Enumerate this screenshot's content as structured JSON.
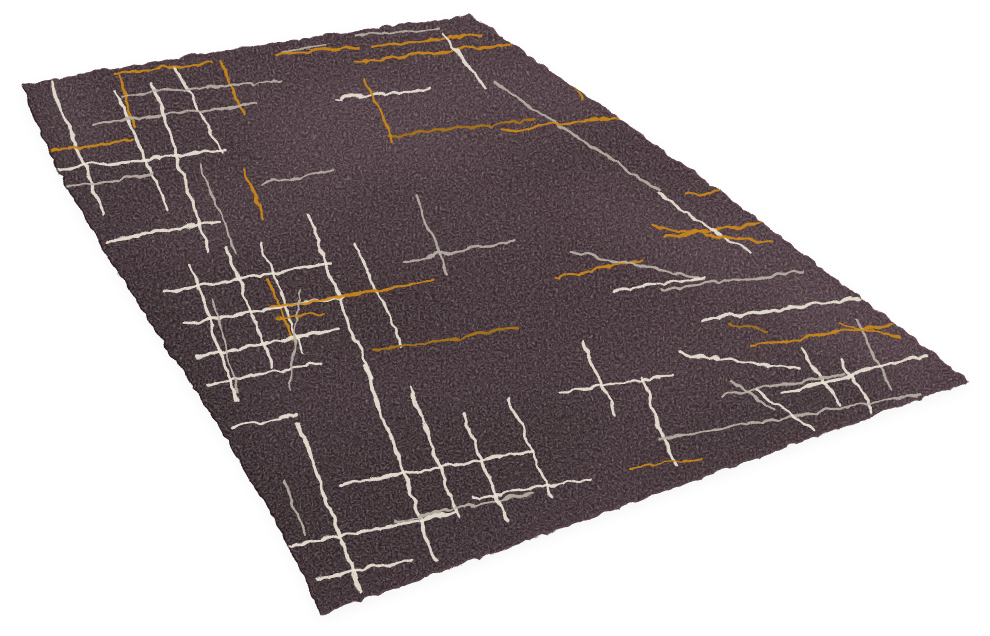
{
  "scene": {
    "type": "product-photo",
    "subject": "Hand-tufted rectangular area rug in dark espresso plum with abstract scratched criss-cross line pattern in ivory, silver-grey and goldenrod, photographed at an angle on a plain white background",
    "background_color": "#ffffff",
    "rug": {
      "outline": {
        "left_corner": [
          21,
          83
        ],
        "top_corner": [
          468,
          14
        ],
        "right_corner": [
          968,
          380
        ],
        "bottom_corner": [
          318,
          614
        ],
        "ctrl_top_edge": [
          244,
          42
        ],
        "ctrl_right_edge": [
          692,
          163
        ],
        "ctrl_bottom_edge": [
          643,
          497
        ],
        "ctrl_left_edge_1": [
          60,
          225
        ],
        "ctrl_left_edge_2": [
          255,
          445
        ]
      },
      "ground_gradient": [
        "#2c2024",
        "#392a2f",
        "#443238",
        "#4e3b42"
      ],
      "line_colors": {
        "iv": "#e9e3d5",
        "si": "#b7afa4",
        "go": "#c9861d",
        "am": "#a87418"
      },
      "rim_colors": {
        "top": "#5e474d",
        "right": "#6d5056",
        "bottom": "#6b5153",
        "left": "#1f1418"
      },
      "shadow_color": "#8a8284",
      "seed": 7,
      "patches": [
        [
          430,
          120,
          180,
          48,
          -8,
          "#6a525c",
          0.28
        ],
        [
          700,
          235,
          150,
          42,
          21,
          "#655058",
          0.24
        ],
        [
          250,
          205,
          120,
          36,
          -14,
          "#5d4950",
          0.2
        ],
        [
          855,
          330,
          95,
          30,
          26,
          "#6e575f",
          0.26
        ],
        [
          75,
          115,
          55,
          24,
          62,
          "#6b565e",
          0.28
        ],
        [
          300,
          95,
          90,
          26,
          -10,
          "#5f4a52",
          0.22
        ],
        [
          180,
          420,
          160,
          62,
          62,
          "#1f1518",
          0.3
        ],
        [
          420,
          480,
          200,
          62,
          -19,
          "#241a1e",
          0.28
        ],
        [
          600,
          155,
          150,
          42,
          14,
          "#2a1e23",
          0.22
        ],
        [
          330,
          305,
          110,
          44,
          8,
          "#271b1f",
          0.2
        ],
        [
          760,
          420,
          130,
          36,
          -18,
          "#231a1e",
          0.24
        ],
        [
          520,
          300,
          160,
          54,
          -5,
          "#2c1f24",
          0.18
        ]
      ],
      "lines": [
        [
          50,
          82,
          102,
          214,
          "iv",
          3
        ],
        [
          114,
          90,
          166,
          208,
          "iv",
          3
        ],
        [
          172,
          64,
          220,
          150,
          "iv",
          2.5
        ],
        [
          117,
          72,
          133,
          122,
          "go",
          2.5
        ],
        [
          218,
          58,
          242,
          112,
          "go",
          2.5
        ],
        [
          52,
          168,
          224,
          148,
          "iv",
          3
        ],
        [
          58,
          187,
          152,
          172,
          "si",
          2.5
        ],
        [
          105,
          240,
          218,
          220,
          "iv",
          3
        ],
        [
          48,
          150,
          130,
          138,
          "go",
          2.5
        ],
        [
          92,
          122,
          254,
          102,
          "si",
          2.5
        ],
        [
          150,
          80,
          208,
          250,
          "iv",
          3
        ],
        [
          112,
          72,
          210,
          61,
          "go",
          2.5
        ],
        [
          198,
          162,
          235,
          252,
          "si",
          2
        ],
        [
          120,
          95,
          280,
          79,
          "si",
          2
        ],
        [
          279,
          50,
          326,
          44,
          "si",
          2
        ],
        [
          354,
          60,
          562,
          38,
          "go",
          2.5
        ],
        [
          370,
          45,
          480,
          33,
          "go",
          2.5
        ],
        [
          274,
          53,
          360,
          45,
          "go",
          2.5
        ],
        [
          354,
          34,
          436,
          27,
          "si",
          2
        ],
        [
          442,
          32,
          484,
          88,
          "iv",
          2.5
        ],
        [
          492,
          80,
          660,
          190,
          "si",
          2.5
        ],
        [
          502,
          130,
          658,
          111,
          "go",
          2.5
        ],
        [
          388,
          135,
          532,
          119,
          "am",
          2.5
        ],
        [
          337,
          98,
          427,
          87,
          "iv",
          2.5
        ],
        [
          364,
          77,
          392,
          142,
          "go",
          2.5
        ],
        [
          548,
          42,
          580,
          97,
          "go",
          2.5
        ],
        [
          684,
          194,
          908,
          163,
          "go",
          2.5
        ],
        [
          662,
          235,
          838,
          212,
          "go",
          2.5
        ],
        [
          662,
          288,
          802,
          270,
          "si",
          2.5
        ],
        [
          702,
          318,
          892,
          292,
          "iv",
          3
        ],
        [
          748,
          345,
          906,
          320,
          "go",
          2.5
        ],
        [
          840,
          357,
          872,
          411,
          "iv",
          3
        ],
        [
          854,
          318,
          890,
          388,
          "si",
          2.5
        ],
        [
          800,
          345,
          838,
          405,
          "iv",
          2.5
        ],
        [
          836,
          322,
          898,
          335,
          "go",
          2
        ],
        [
          726,
          322,
          769,
          331,
          "am",
          2
        ],
        [
          658,
          193,
          750,
          253,
          "iv",
          2.5
        ],
        [
          680,
          352,
          796,
          368,
          "iv",
          2.5
        ],
        [
          650,
          225,
          770,
          241,
          "go",
          2.5
        ],
        [
          554,
          276,
          640,
          259,
          "go",
          2.5
        ],
        [
          569,
          251,
          701,
          277,
          "si",
          2.5
        ],
        [
          613,
          291,
          703,
          275,
          "iv",
          2.5
        ],
        [
          581,
          341,
          613,
          411,
          "iv",
          3
        ],
        [
          641,
          378,
          673,
          464,
          "iv",
          3
        ],
        [
          719,
          394,
          843,
          372,
          "si",
          2.5
        ],
        [
          781,
          391,
          924,
          354,
          "iv",
          3
        ],
        [
          658,
          437,
          918,
          393,
          "si",
          2.5
        ],
        [
          560,
          391,
          672,
          373,
          "iv",
          2.5
        ],
        [
          189,
          263,
          236,
          400,
          "iv",
          3
        ],
        [
          226,
          248,
          271,
          365,
          "iv",
          3
        ],
        [
          259,
          240,
          301,
          350,
          "iv",
          2.5
        ],
        [
          306,
          214,
          369,
          377,
          "iv",
          3
        ],
        [
          354,
          243,
          401,
          345,
          "iv",
          2.5
        ],
        [
          243,
          168,
          262,
          218,
          "go",
          2.5
        ],
        [
          266,
          279,
          293,
          340,
          "go",
          2.5
        ],
        [
          161,
          290,
          331,
          262,
          "iv",
          3
        ],
        [
          183,
          323,
          341,
          295,
          "iv",
          3
        ],
        [
          196,
          355,
          336,
          328,
          "iv",
          3
        ],
        [
          269,
          307,
          432,
          279,
          "go",
          2.5
        ],
        [
          206,
          383,
          321,
          361,
          "iv",
          2.5
        ],
        [
          258,
          182,
          333,
          170,
          "si",
          2
        ],
        [
          414,
          194,
          446,
          272,
          "si",
          2.5
        ],
        [
          403,
          260,
          514,
          238,
          "si",
          2.5
        ],
        [
          373,
          350,
          514,
          327,
          "am",
          2.5
        ],
        [
          211,
          299,
          237,
          392,
          "si",
          2
        ],
        [
          297,
          291,
          289,
          391,
          "si",
          2
        ],
        [
          232,
          426,
          293,
          414,
          "iv",
          2.5
        ],
        [
          274,
          317,
          322,
          312,
          "go",
          2
        ],
        [
          296,
          421,
          359,
          591,
          "iv",
          3.5
        ],
        [
          363,
          366,
          434,
          558,
          "iv",
          3.5
        ],
        [
          409,
          386,
          456,
          514,
          "iv",
          3
        ],
        [
          281,
          478,
          303,
          532,
          "si",
          2.5
        ],
        [
          283,
          545,
          453,
          512,
          "iv",
          3
        ],
        [
          316,
          577,
          409,
          559,
          "iv",
          3
        ],
        [
          341,
          483,
          531,
          449,
          "iv",
          3
        ],
        [
          393,
          520,
          533,
          491,
          "si",
          2.5
        ],
        [
          461,
          412,
          505,
          521,
          "iv",
          3
        ],
        [
          509,
          400,
          551,
          496,
          "iv",
          2.5
        ],
        [
          471,
          498,
          591,
          477,
          "iv",
          2.5
        ],
        [
          629,
          468,
          701,
          456,
          "go",
          2
        ],
        [
          731,
          381,
          771,
          408,
          "si",
          2.5
        ],
        [
          753,
          389,
          813,
          429,
          "iv",
          2.5
        ]
      ]
    }
  }
}
